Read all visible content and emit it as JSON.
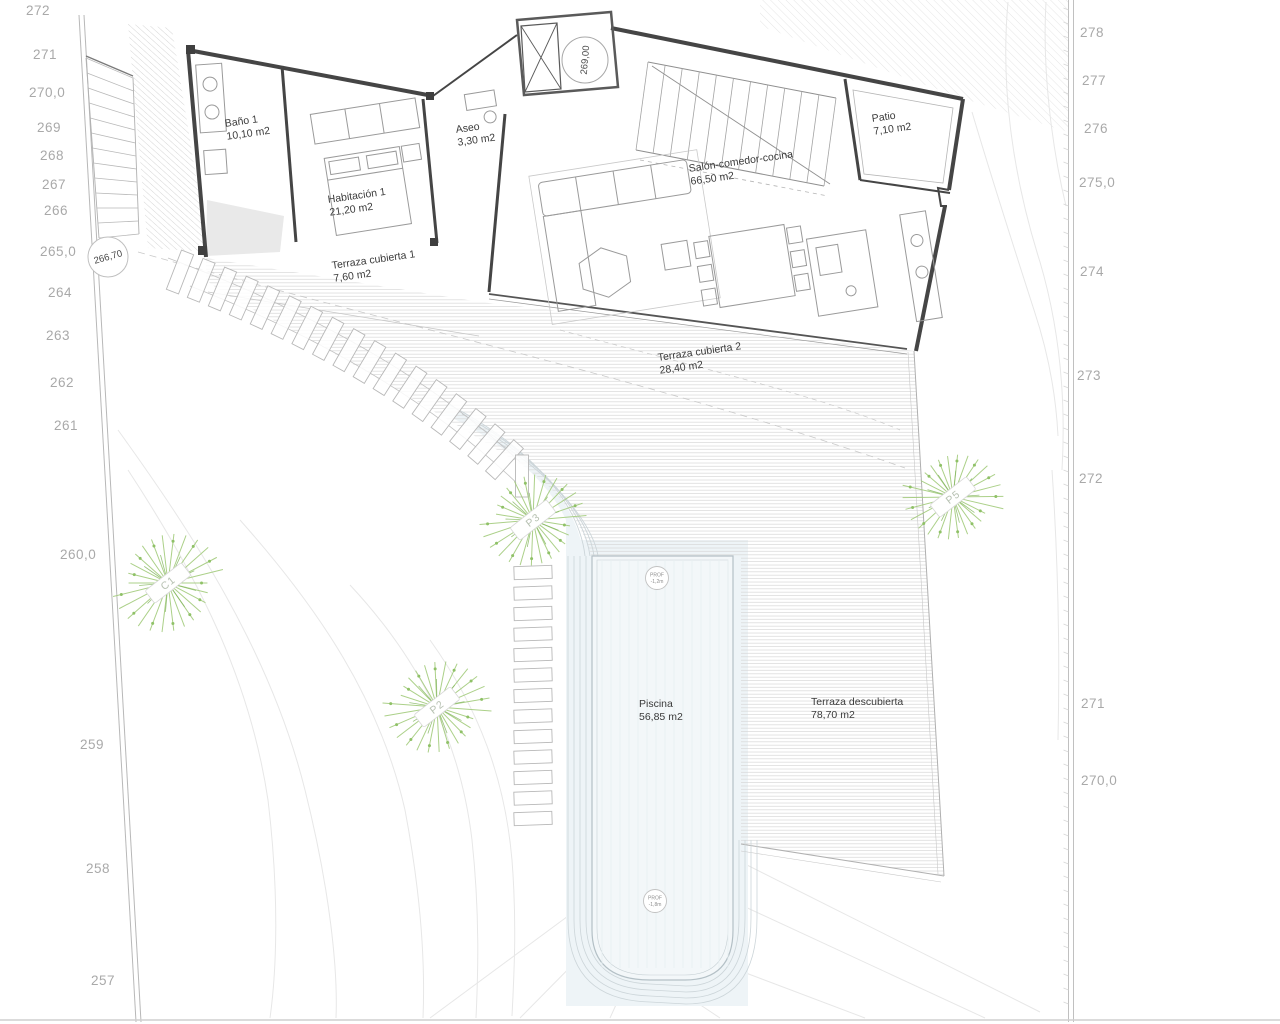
{
  "rooms": [
    {
      "name": "Baño 1",
      "area": "10,10 m2"
    },
    {
      "name": "Habitación 1",
      "area": "21,20 m2"
    },
    {
      "name": "Aseo",
      "area": "3,30 m2"
    },
    {
      "name": "Terraza cubierta 1",
      "area": "7,60 m2"
    },
    {
      "name": "Salón-comedor-cocina",
      "area": "66,50 m2"
    },
    {
      "name": "Patio",
      "area": "7,10 m2"
    },
    {
      "name": "Terraza cubierta 2",
      "area": "28,40 m2"
    },
    {
      "name": "Piscina",
      "area": "56,85 m2"
    },
    {
      "name": "Terraza descubierta",
      "area": "78,70 m2"
    }
  ],
  "contours": {
    "left": [
      "272",
      "271",
      "270,0",
      "269",
      "268",
      "267",
      "266",
      "265,0",
      "264",
      "263",
      "262",
      "261",
      "260,0",
      "259",
      "258",
      "257"
    ],
    "right": [
      "278",
      "277",
      "276",
      "275,0",
      "274",
      "273",
      "272",
      "271",
      "270,0"
    ]
  },
  "spot_elevations": [
    {
      "value": "266,70"
    },
    {
      "value": "269,00"
    }
  ],
  "pool_depth_markers": [
    {
      "line1": "PROF",
      "line2": "-1,2m"
    },
    {
      "line1": "PROF",
      "line2": "-1,8m"
    }
  ],
  "trees": [
    {
      "label": "C1"
    },
    {
      "label": "P3"
    },
    {
      "label": "P2"
    },
    {
      "label": "P5"
    }
  ],
  "colors": {
    "wall": "#454545",
    "thin": "#9a9a9a",
    "hatch": "#d7d7d7",
    "contour": "#e7e7e7",
    "tree_green": "#a3cb7c",
    "tree_dot": "#8fc167",
    "tree_label_text": "#b7c1b2",
    "pool_fill": "#f3f7f9",
    "pool_edge": "#b4c0c6",
    "deck_line": "#ccd5d9",
    "label_text": "#3a3a3a",
    "elevation_text": "#a9a9a9",
    "boundary": "#b8b8b8"
  }
}
